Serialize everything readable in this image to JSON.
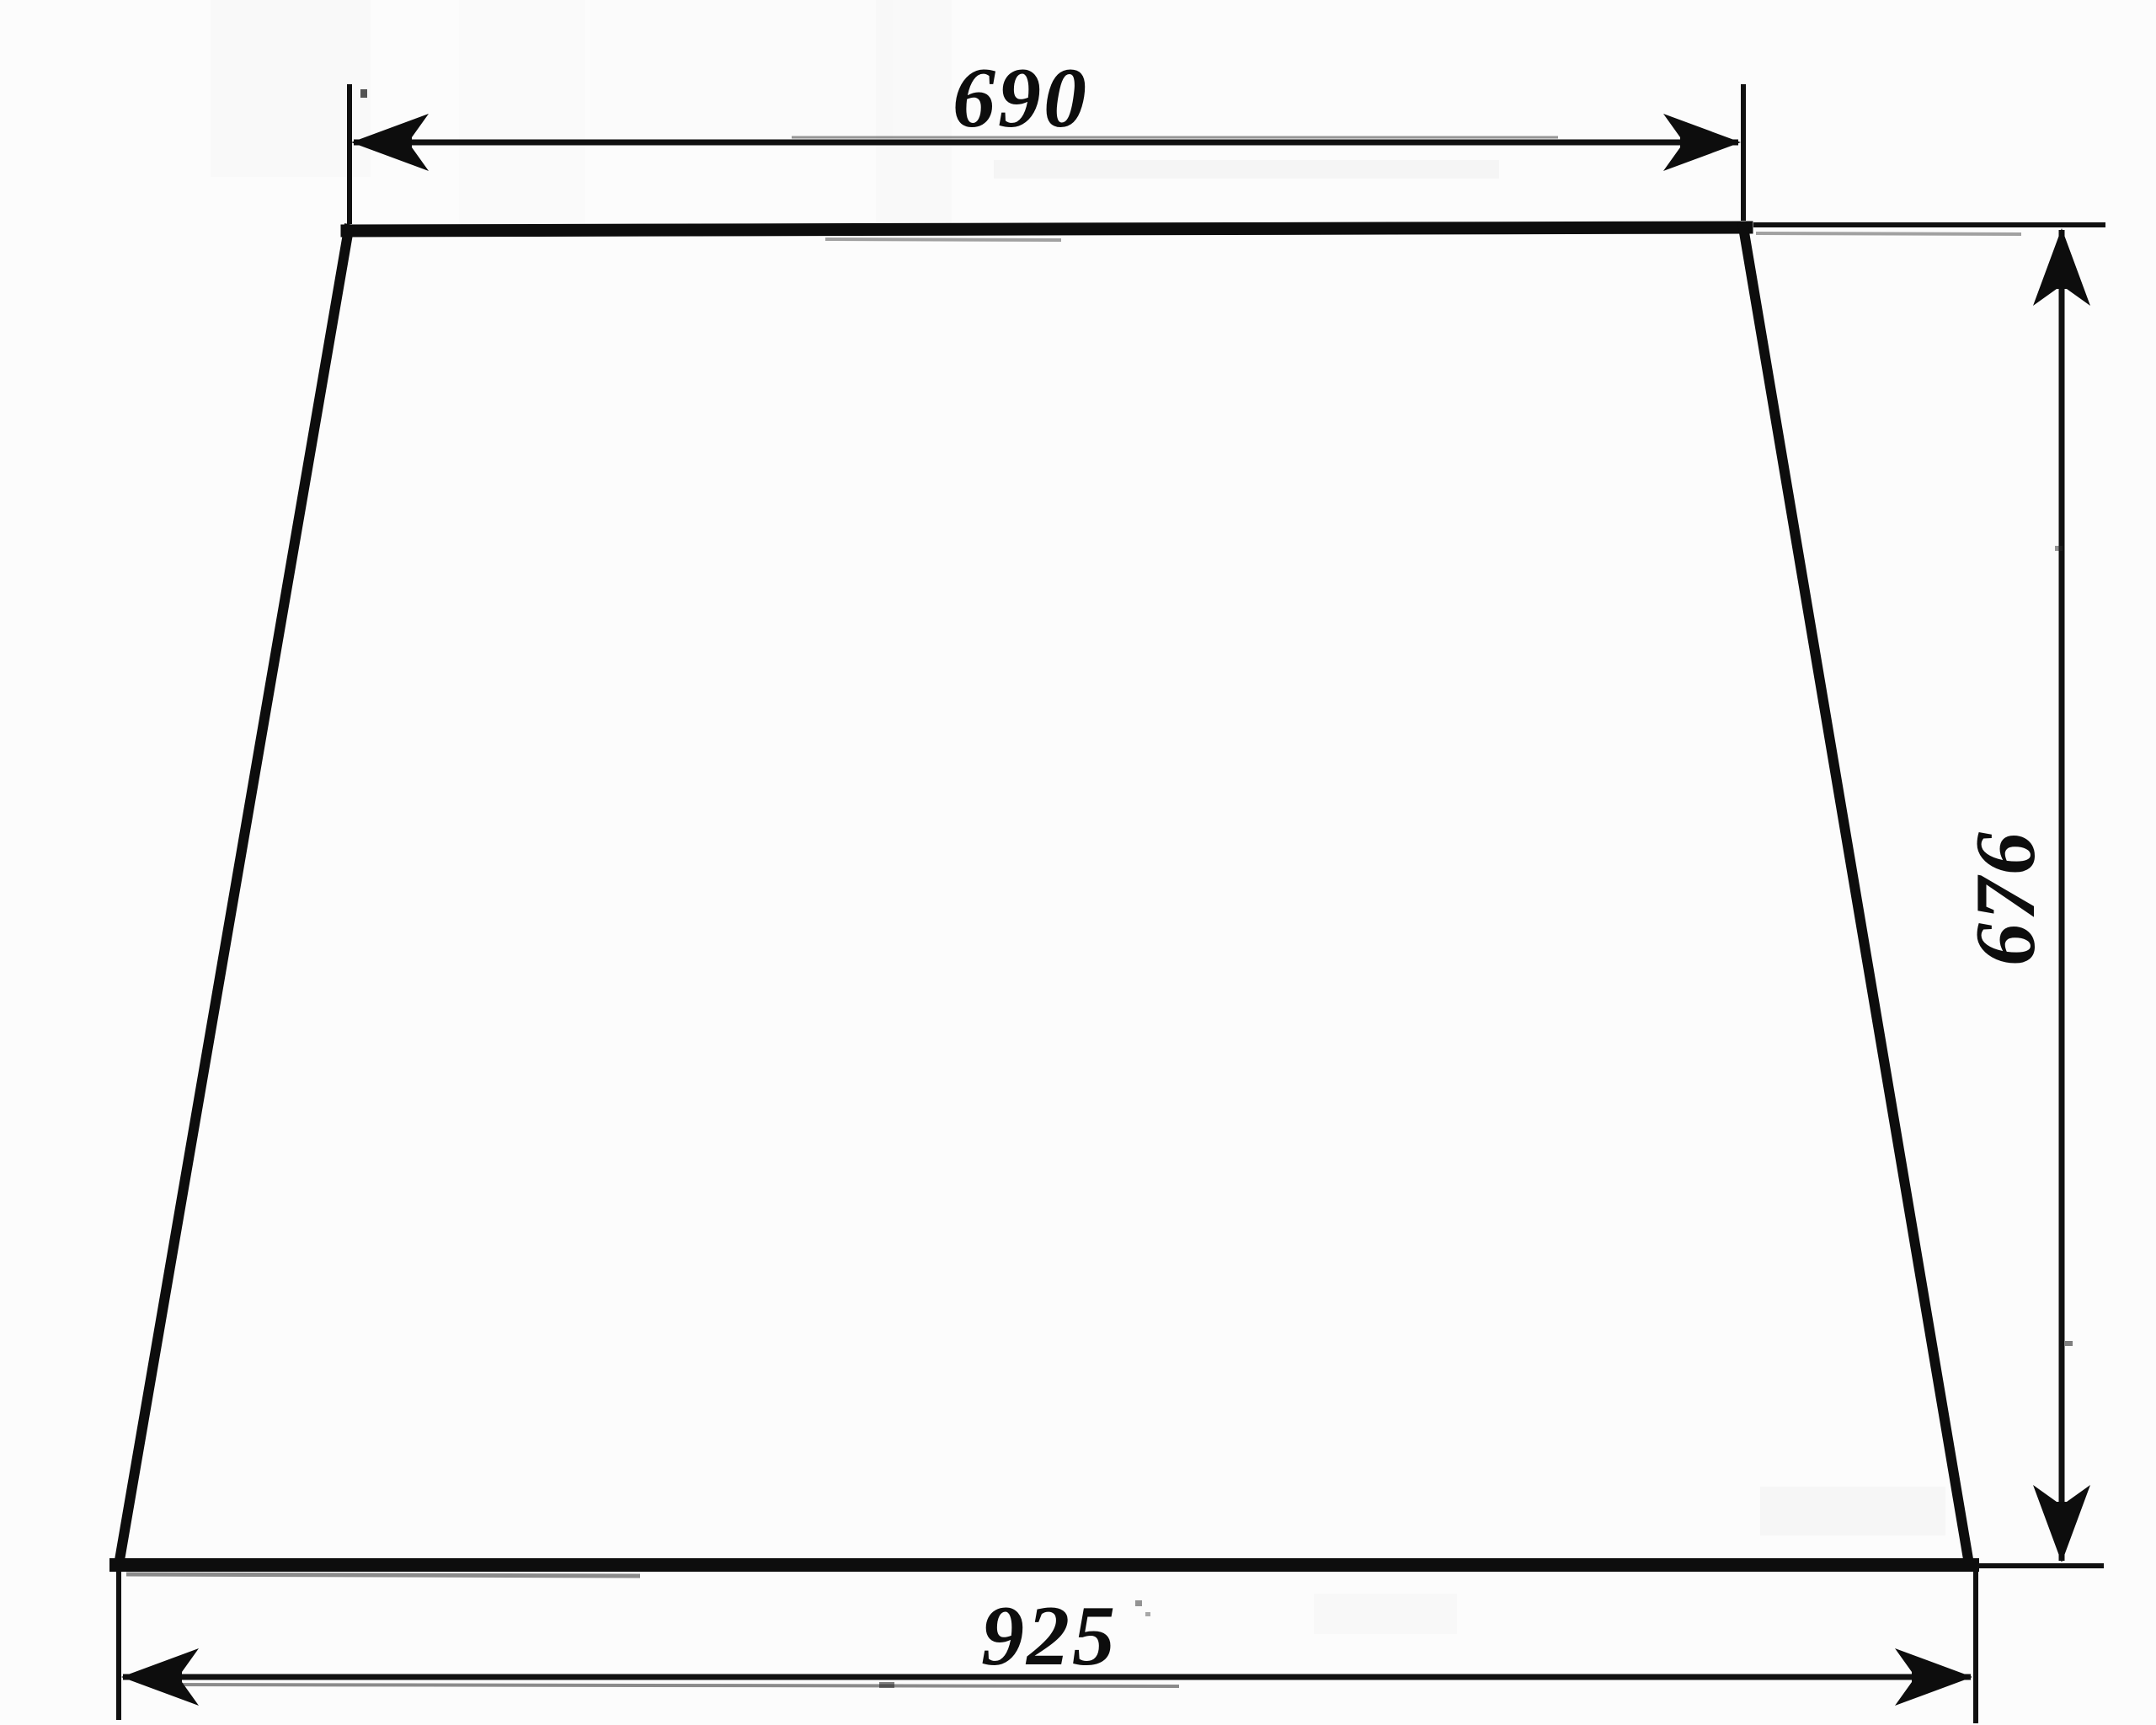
{
  "diagram": {
    "type": "technical-drawing",
    "shape": "trapezoid-panel-outline",
    "ink_color": "#0d0d0d",
    "paper_color": "#fcfcfc",
    "dimensions": {
      "top_width": {
        "label": "690",
        "orientation": "horizontal",
        "position": "top"
      },
      "right_height": {
        "label": "676",
        "orientation": "vertical",
        "position": "right"
      },
      "bottom_width": {
        "label": "925",
        "orientation": "horizontal",
        "position": "bottom"
      }
    }
  }
}
